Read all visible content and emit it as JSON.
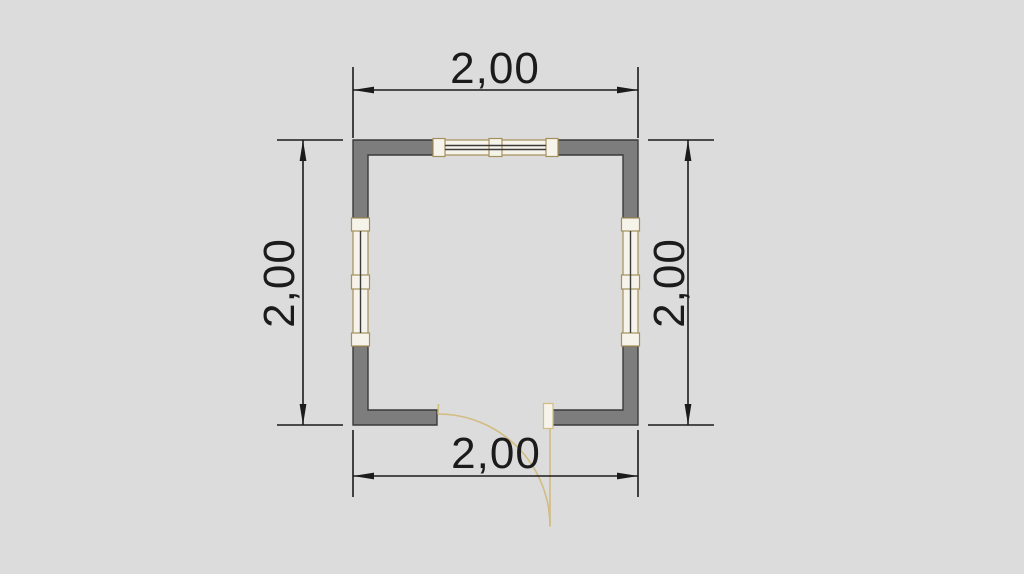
{
  "colors": {
    "background": "#dcdcdc",
    "wall_fill": "#7d7d7d",
    "wall_stroke": "#3a3a3a",
    "window_fill": "#f6f3ea",
    "window_frame": "#a3905c",
    "window_glass": "#3a3a3a",
    "door": "#d2bc82",
    "dim_color": "#1b1b1b"
  },
  "plan": {
    "type": "floor-plan",
    "room": {
      "width_label": "2,00",
      "depth_label": "2,00"
    },
    "dimensions": {
      "top": {
        "label": "2,00"
      },
      "bottom": {
        "label": "2,00"
      },
      "left": {
        "label": "2,00"
      },
      "right": {
        "label": "2,00"
      }
    },
    "features": {
      "windows": [
        "top-wall-window",
        "left-wall-window",
        "right-wall-window"
      ],
      "doors": [
        "bottom-wall-door-swing-right"
      ]
    }
  }
}
